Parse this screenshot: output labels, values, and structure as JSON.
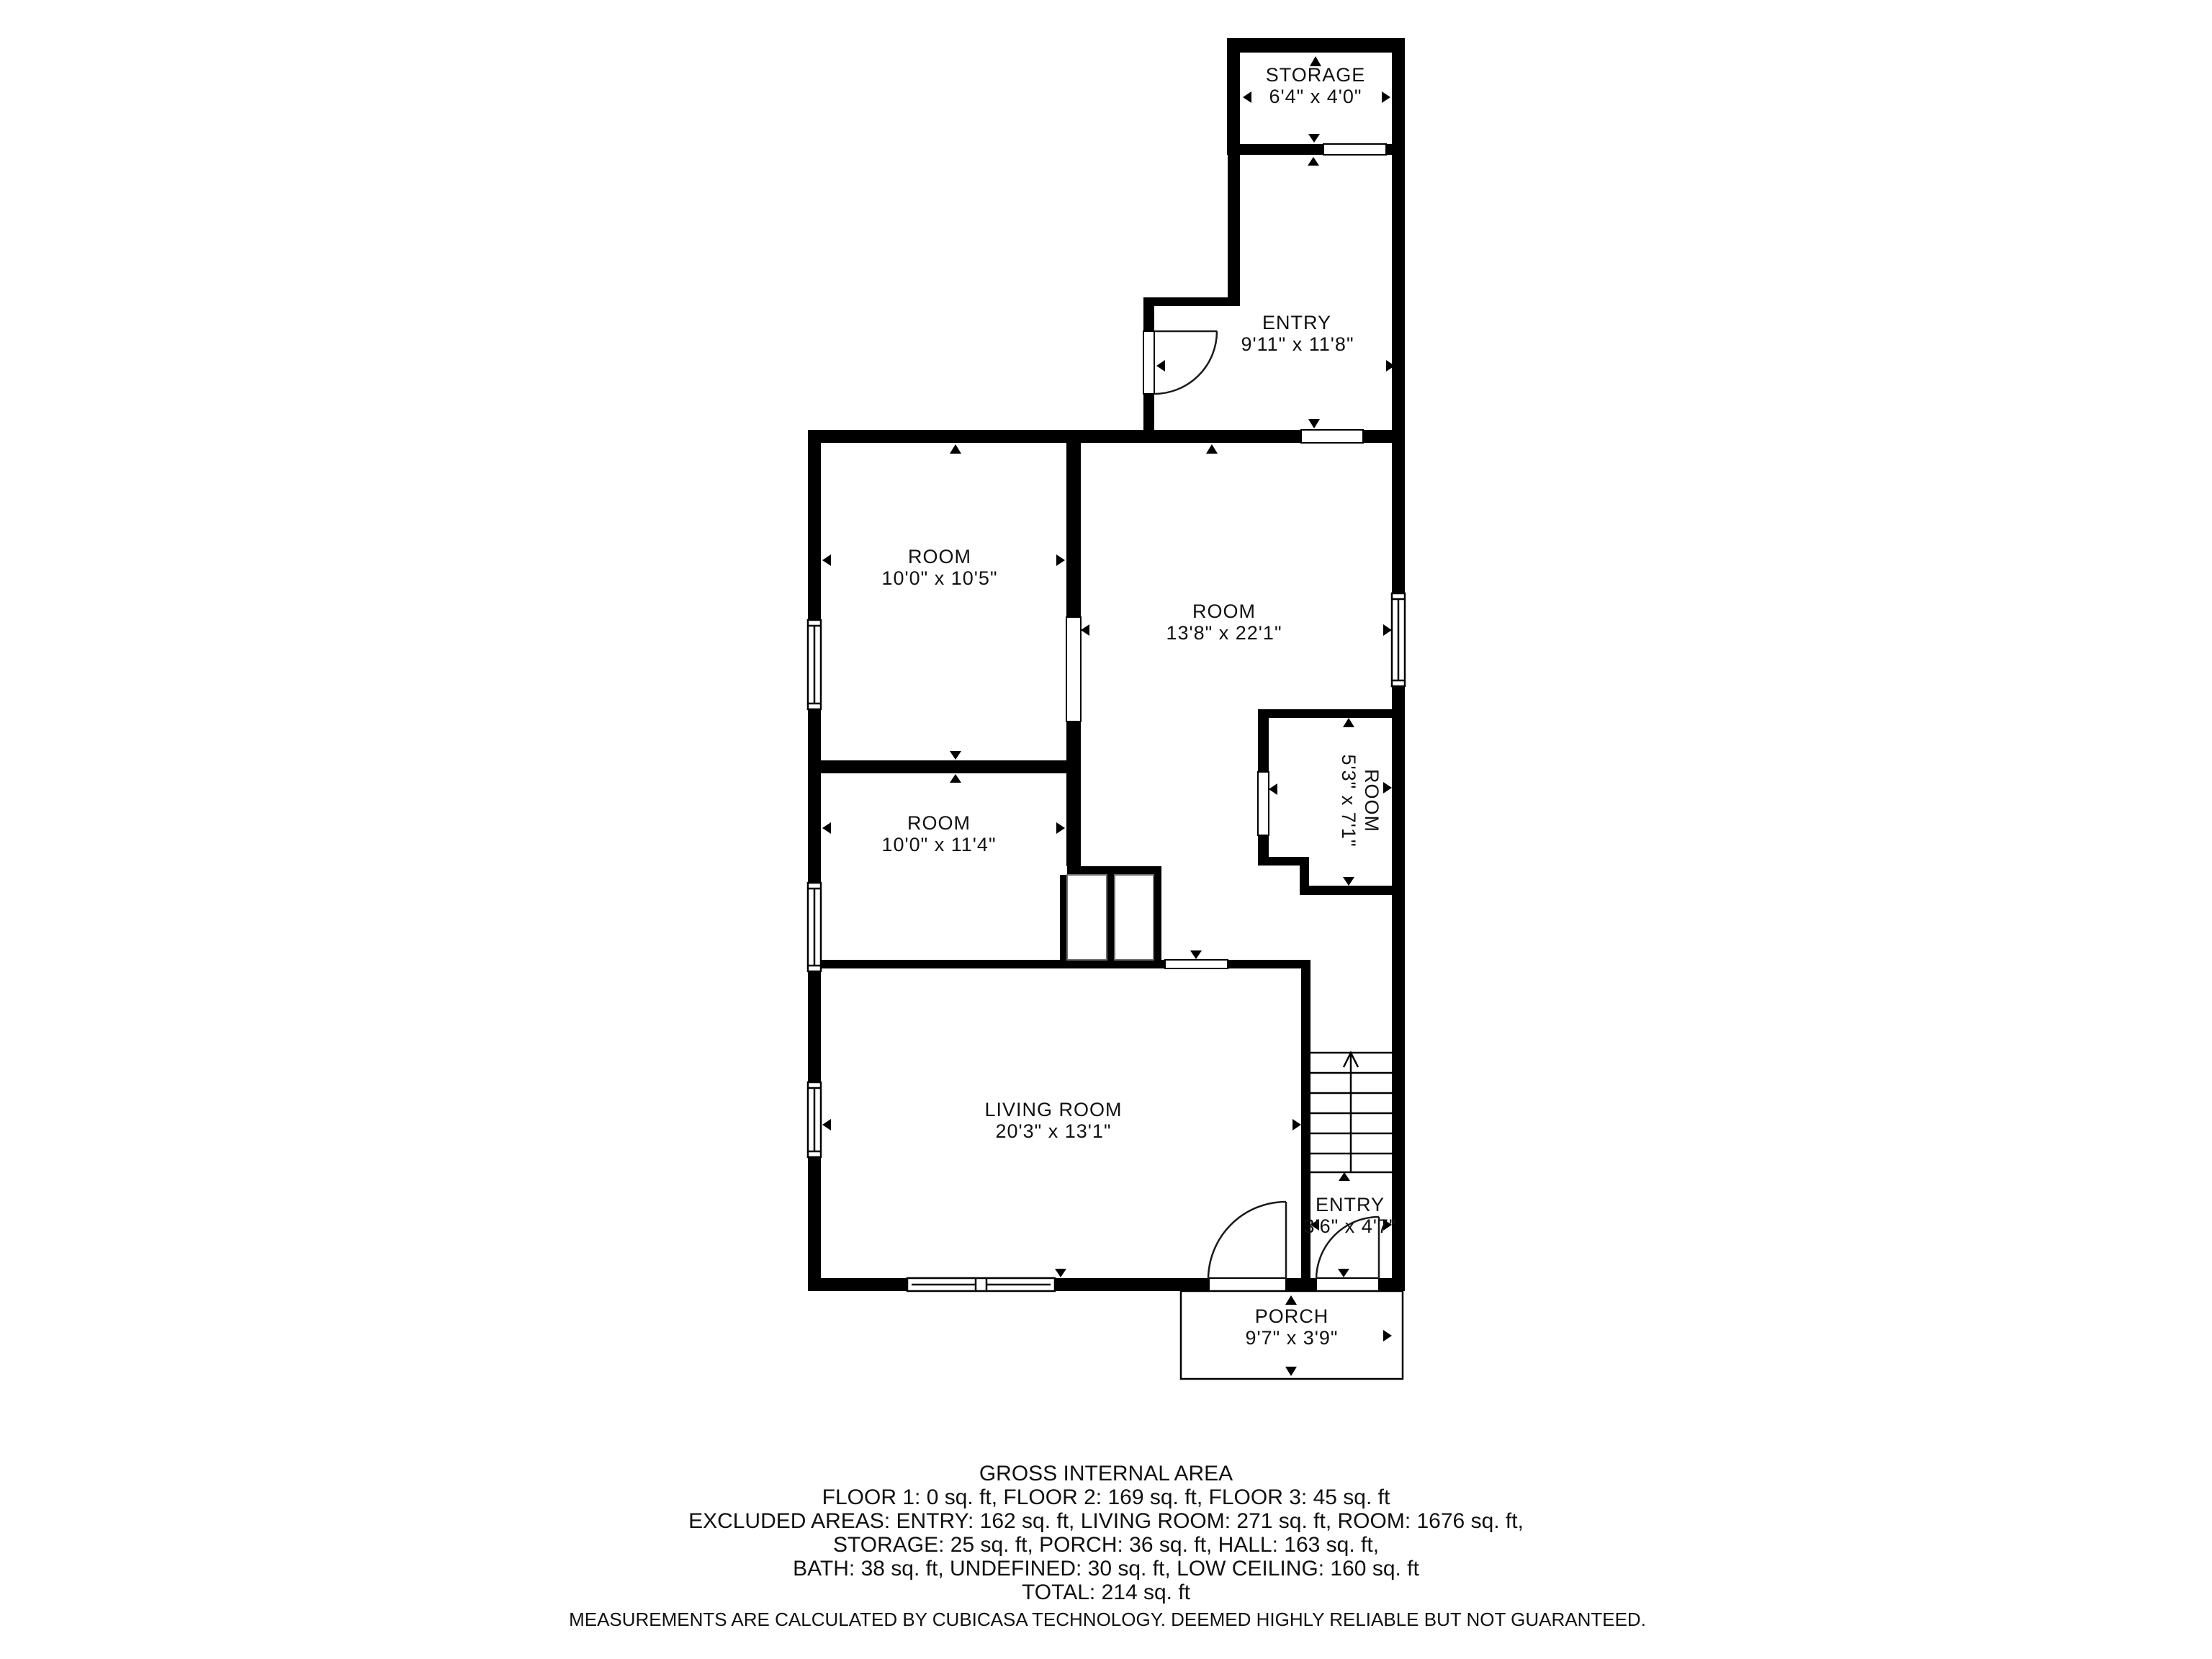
{
  "colors": {
    "wall": "#000000",
    "background": "#ffffff"
  },
  "rooms": [
    {
      "id": "storage",
      "name": "STORAGE",
      "dims": "6'4\" x 4'0\""
    },
    {
      "id": "entry-upper",
      "name": "ENTRY",
      "dims": "9'11\" x 11'8\""
    },
    {
      "id": "room-1",
      "name": "ROOM",
      "dims": "10'0\" x 10'5\""
    },
    {
      "id": "room-large",
      "name": "ROOM",
      "dims": "13'8\" x 22'1\""
    },
    {
      "id": "room-small",
      "name": "ROOM",
      "dims": "5'3\" x 7'1\""
    },
    {
      "id": "room-2",
      "name": "ROOM",
      "dims": "10'0\" x 11'4\""
    },
    {
      "id": "living-room",
      "name": "LIVING ROOM",
      "dims": "20'3\" x 13'1\""
    },
    {
      "id": "entry-lower",
      "name": "ENTRY",
      "dims": "3'6\" x 4'7\""
    },
    {
      "id": "porch",
      "name": "PORCH",
      "dims": "9'7\" x 3'9\""
    }
  ],
  "summary": {
    "title": "GROSS INTERNAL AREA",
    "lines": [
      "FLOOR 1: 0 sq. ft, FLOOR 2: 169 sq. ft, FLOOR 3: 45 sq. ft",
      "EXCLUDED AREAS: ENTRY: 162 sq. ft, LIVING ROOM: 271 sq. ft, ROOM: 1676 sq. ft,",
      "STORAGE: 25 sq. ft, PORCH: 36 sq. ft, HALL: 163 sq. ft,",
      "BATH: 38 sq. ft, UNDEFINED: 30 sq. ft, LOW CEILING: 160 sq. ft",
      "TOTAL: 214 sq. ft"
    ],
    "disclaimer": "MEASUREMENTS ARE CALCULATED BY CUBICASA TECHNOLOGY. DEEMED HIGHLY RELIABLE BUT NOT GUARANTEED."
  }
}
